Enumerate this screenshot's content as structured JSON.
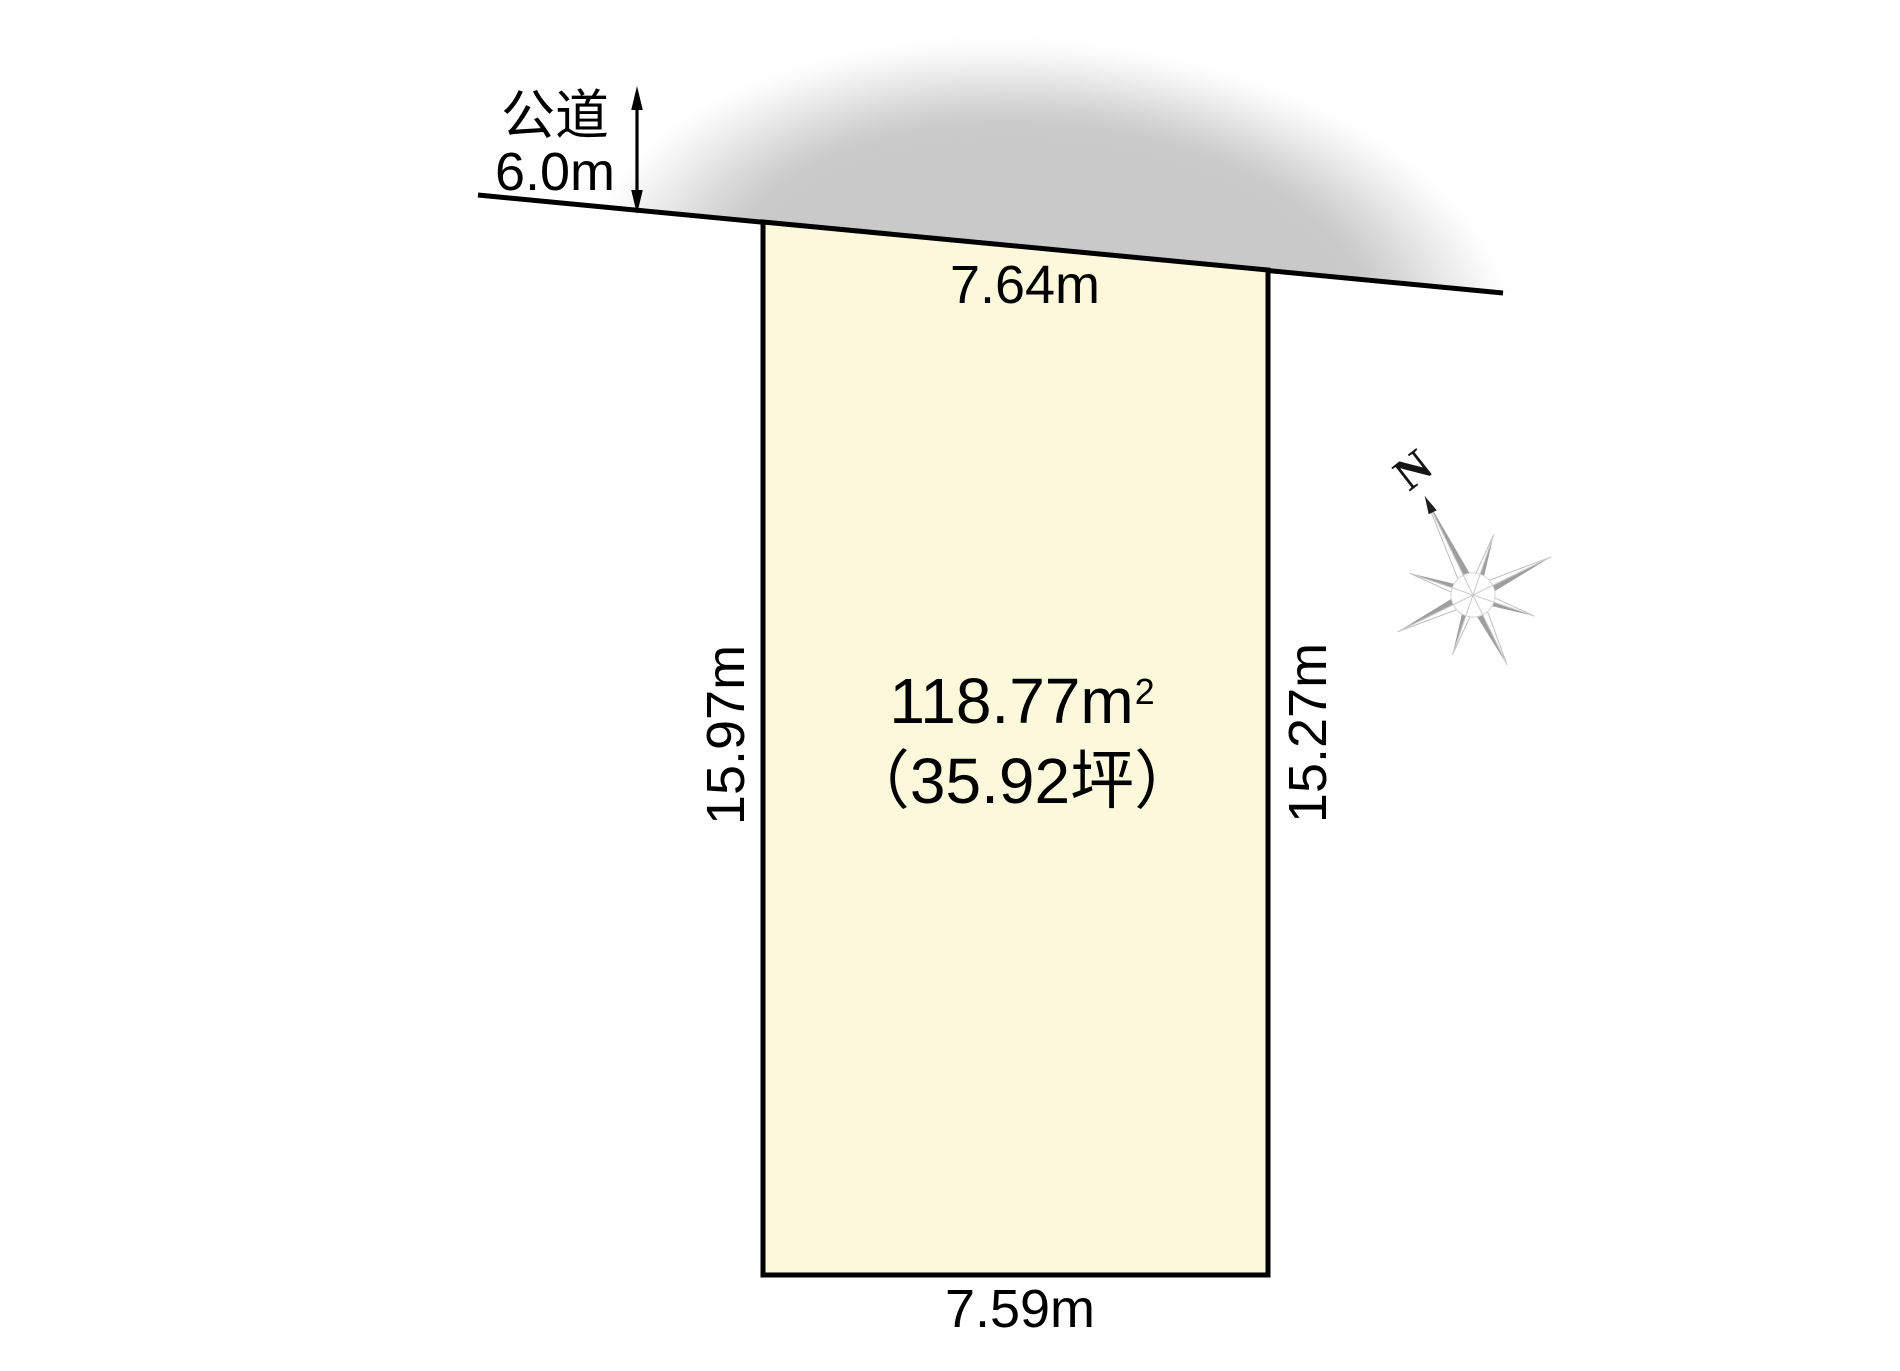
{
  "diagram_title": "land-plot-site-plan",
  "road": {
    "name_label": "公道",
    "width_label": "6.0m"
  },
  "plot": {
    "area_value_unit": "118.77m",
    "area_sup": "2",
    "area_tsubo": "（35.92坪）",
    "dim_top": "7.64m",
    "dim_bottom": "7.59m",
    "dim_left": "15.97m",
    "dim_right": "15.27m"
  },
  "compass": {
    "north_label": "N"
  },
  "colors": {
    "plot_fill": "#fcf8dc",
    "plot_stroke": "#000000",
    "road_fill": "#c9c9c9",
    "line_color": "#000000",
    "compass_gray": "#9e9e9e",
    "background": "#ffffff"
  }
}
